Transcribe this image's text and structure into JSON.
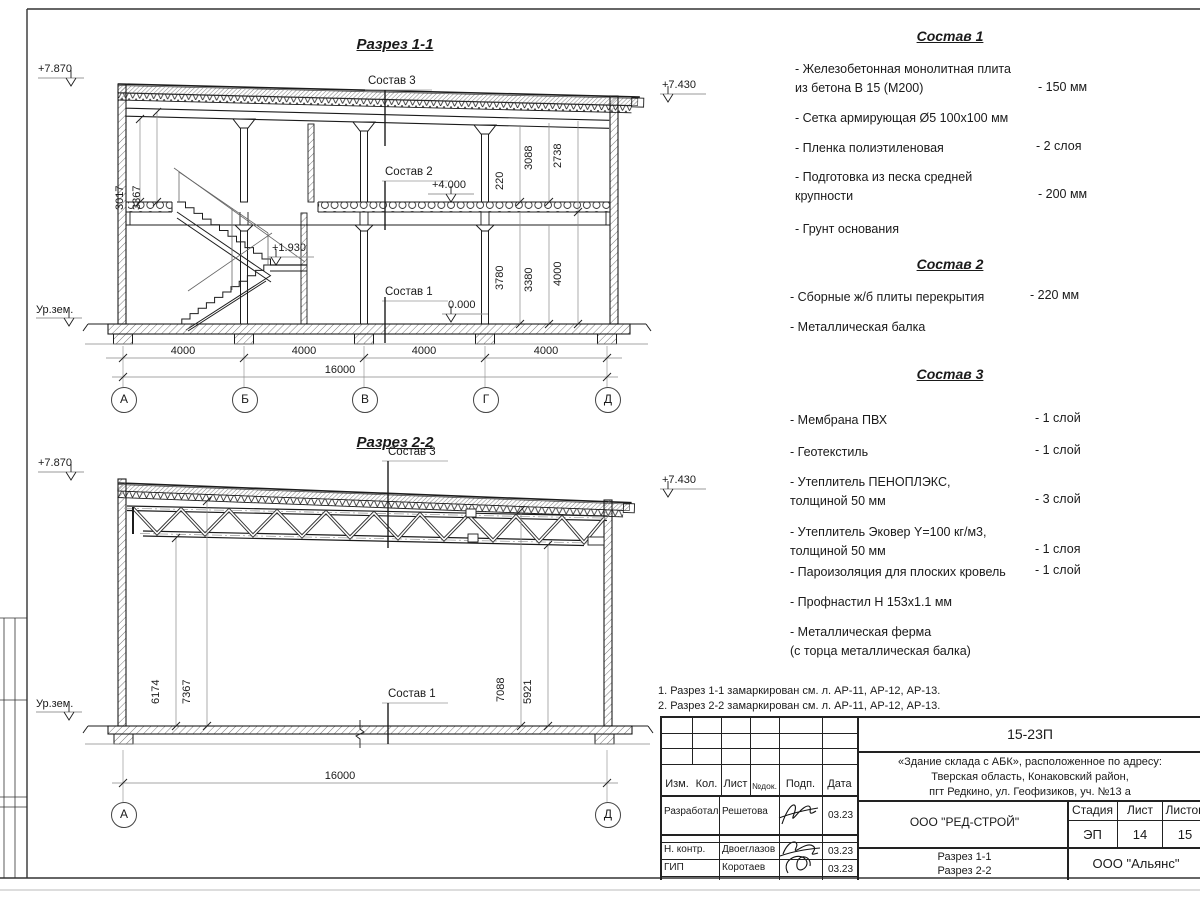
{
  "section1": {
    "title": "Разрез 1-1",
    "levels": {
      "top_left": "+7.870",
      "top_right": "+7.430",
      "ground": "Ур.зем.",
      "slab": "+4.000",
      "zero": "0.000",
      "landing": "+1.930"
    },
    "labels": {
      "sostav3": "Состав 3",
      "sostav2": "Состав 2",
      "sostav1": "Состав 1"
    },
    "dims": {
      "left": [
        "3017",
        "3367"
      ],
      "right_upper": [
        "220",
        "3088",
        "2738"
      ],
      "right_lower": [
        "3780",
        "3380",
        "4000"
      ],
      "spans": [
        "4000",
        "4000",
        "4000",
        "4000"
      ],
      "total": "16000"
    },
    "axes": [
      "А",
      "Б",
      "В",
      "Г",
      "Д"
    ]
  },
  "section2": {
    "title": "Разрез 2-2",
    "levels": {
      "top_left": "+7.870",
      "top_right": "+7.430",
      "ground": "Ур.зем."
    },
    "labels": {
      "sostav3": "Состав 3",
      "sostav1": "Состав 1"
    },
    "dims": {
      "left": [
        "6174",
        "7367"
      ],
      "right": [
        "7088",
        "5921"
      ],
      "total": "16000"
    },
    "axes": [
      "А",
      "Д"
    ]
  },
  "compositions": [
    {
      "title": "Состав 1",
      "items": [
        {
          "name": "- Железобетонная  монолитная плита\nиз бетона В 15 (М200)",
          "value": "- 150 мм"
        },
        {
          "name": "- Сетка армирующая Ø5 100х100 мм",
          "value": ""
        },
        {
          "name": "- Пленка полиэтиленовая",
          "value": "-  2 слоя"
        },
        {
          "name": "- Подготовка из песка средней\nкрупности",
          "value": "- 200 мм"
        },
        {
          "name": "- Грунт основания",
          "value": ""
        }
      ]
    },
    {
      "title": "Состав 2",
      "items": [
        {
          "name": "- Сборные ж/б плиты перекрытия",
          "value": "- 220 мм"
        },
        {
          "name": "- Металлическая балка",
          "value": ""
        }
      ]
    },
    {
      "title": "Состав 3",
      "items": [
        {
          "name": "- Мембрана ПВХ",
          "value": "- 1 слой"
        },
        {
          "name": "- Геотекстиль",
          "value": "- 1 слой"
        },
        {
          "name": "- Утеплитель ПЕНОПЛЭКС,\nтолщиной 50 мм",
          "value": "- 3 слой"
        },
        {
          "name": "- Утеплитель Эковер Y=100 кг/м3,\nтолщиной 50 мм",
          "value": "- 1 слоя"
        },
        {
          "name": "- Пароизоляция для плоских кровель",
          "value": "- 1 слой"
        },
        {
          "name": "- Профнастил Н 153х1.1 мм",
          "value": ""
        },
        {
          "name": "- Металлическая ферма\n(с торца металлическая балка)",
          "value": ""
        }
      ]
    }
  ],
  "notes": {
    "line1": "1. Разрез 1-1 замаркирован см. л. АР-11, АР-12, АР-13.",
    "line2": "2. Разрез 2-2 замаркирован см. л. АР-11, АР-12, АР-13."
  },
  "titleblock": {
    "doc_number": "15-23П",
    "address": "«Здание склада с АБК», расположенное по адресу:\nТверская область, Конаковский район,\nпгт Редкино, ул. Геофизиков, уч. №13 а",
    "org": "ООО \"РЕД-СТРОЙ\"",
    "stage_label": "Стадия",
    "sheet_label": "Лист",
    "sheets_label": "Листов",
    "stage": "ЭП",
    "sheet": "14",
    "sheets": "15",
    "content": "Разрез 1-1\nРазрез 2-2",
    "contractor": "ООО \"Альянс\"",
    "cols": [
      "Изм.",
      "Кол.",
      "Лист",
      "№док.",
      "Подп.",
      "Дата"
    ],
    "rows": [
      {
        "role": "Разработал",
        "name": "Решетова",
        "date": "03.23"
      },
      {
        "role": "Н. контр.",
        "name": "Двоеглазов",
        "date": "03.23"
      },
      {
        "role": "ГИП",
        "name": "Коротаев",
        "date": "03.23"
      }
    ]
  }
}
